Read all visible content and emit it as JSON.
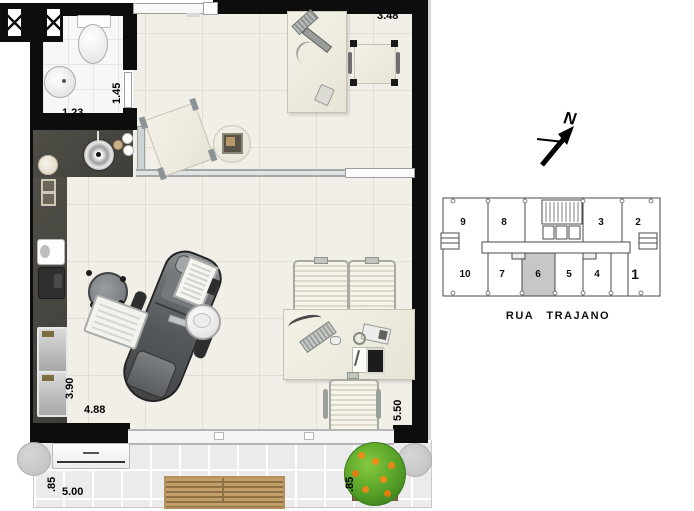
{
  "dimensions": {
    "top_width": "3.48",
    "bath_height": "1.45",
    "bath_width": "1.23",
    "room_height": "3.90",
    "room_width": "4.88",
    "right_height": "5.50",
    "balcony_depth_left": ".85",
    "balcony_width": "5.00",
    "balcony_depth_right": ".85"
  },
  "compass": {
    "north": "N"
  },
  "keyplan": {
    "street": "RUA TRAJANO",
    "units": [
      "9",
      "8",
      "3",
      "2",
      "10",
      "7",
      "6",
      "5",
      "4",
      "1"
    ],
    "highlighted_unit": "6"
  },
  "colors": {
    "wall": "#0d0d0d",
    "floor": "#f1efe7",
    "bath_floor": "#f7f7f7",
    "balcony_floor": "#ebebeb",
    "counter": "#45433e",
    "keyplan_highlight": "#c7c7c7",
    "bench_wood": "#c49e68",
    "plant_green": "#55a028",
    "plant_fruit": "#ef8b1a"
  }
}
